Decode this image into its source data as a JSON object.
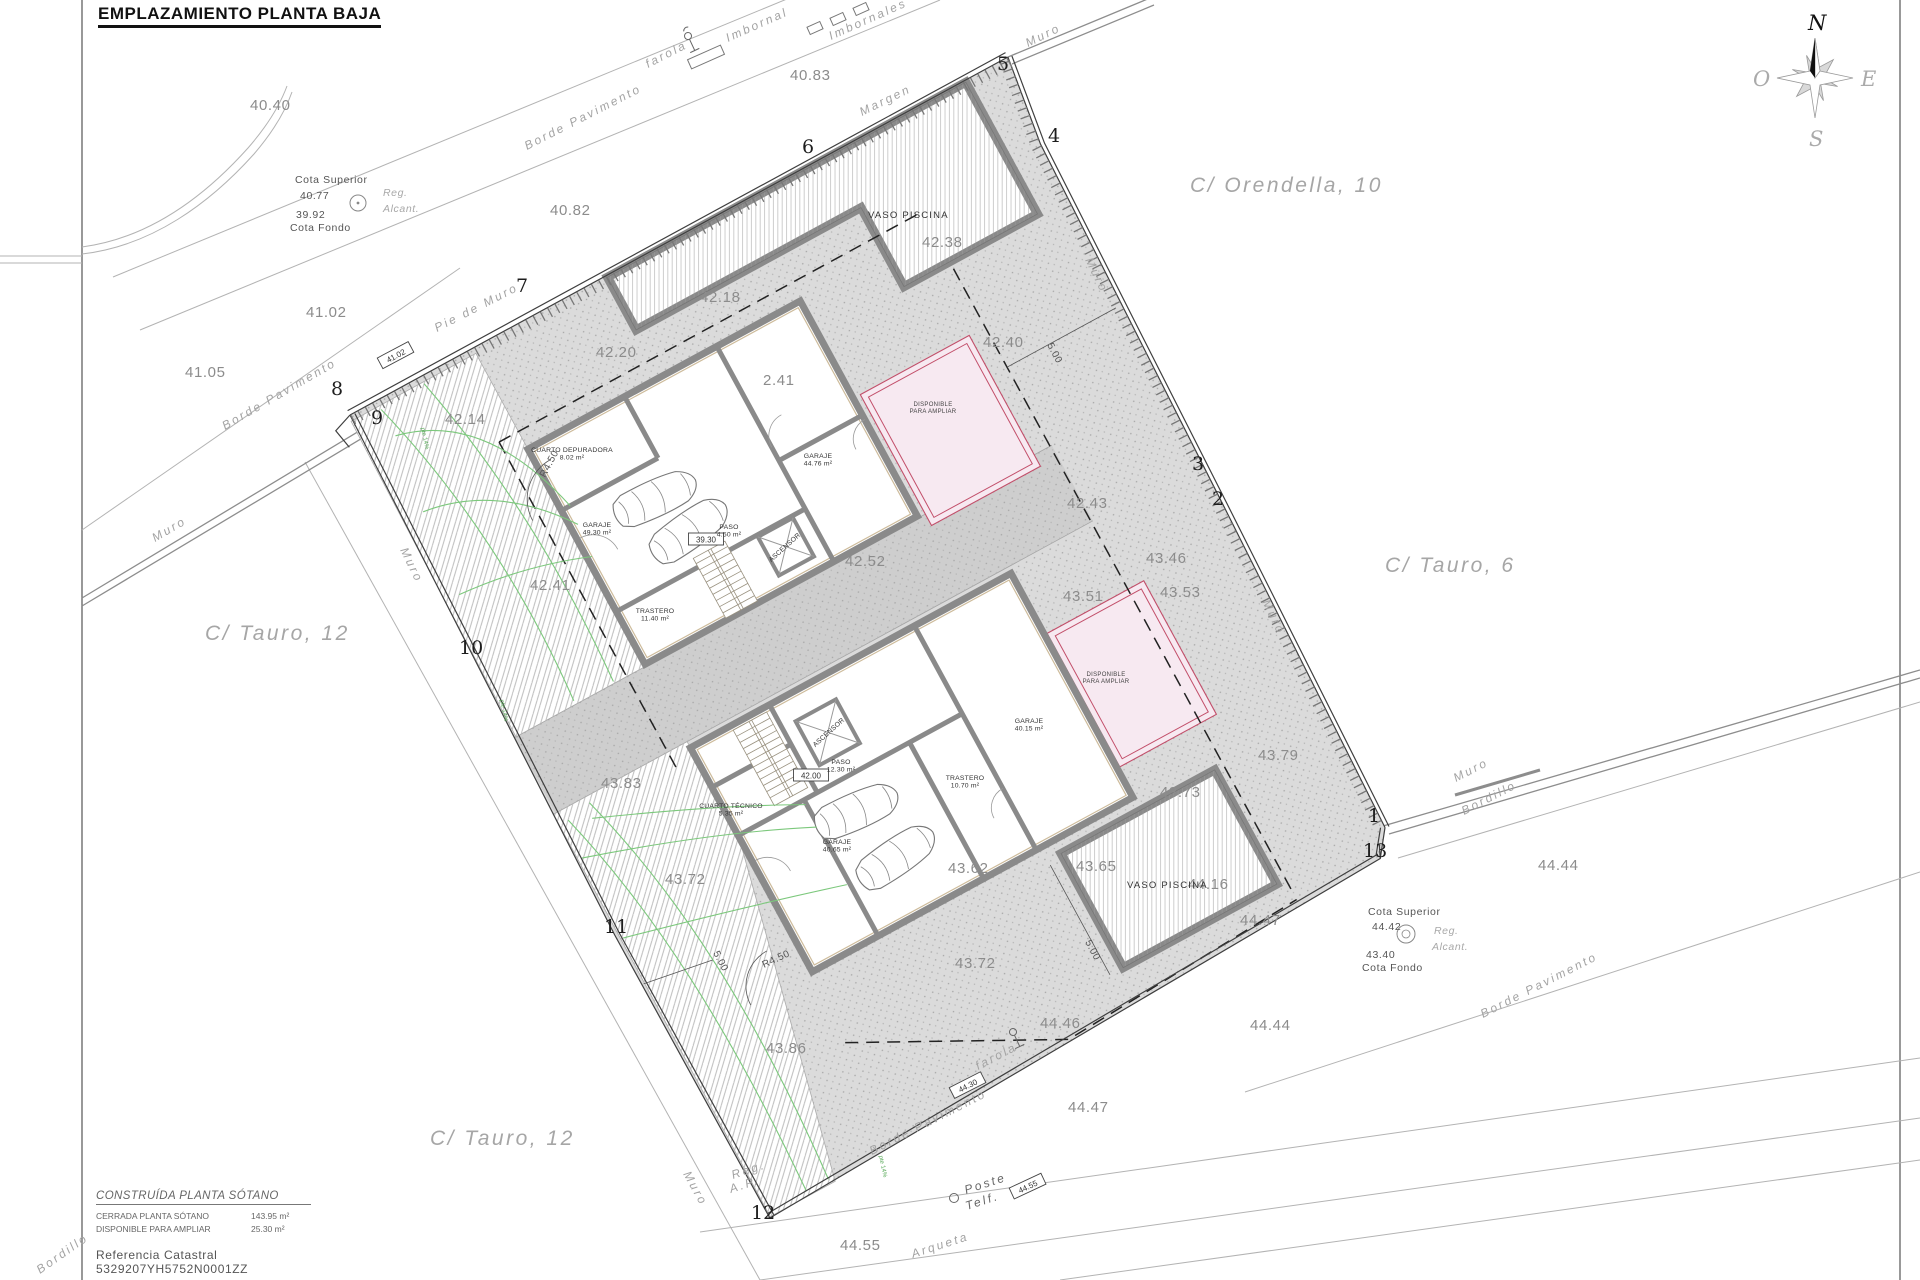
{
  "title": "EMPLAZAMIENTO PLANTA BAJA",
  "compass": {
    "n": "N",
    "s": "S",
    "e": "E",
    "w": "O"
  },
  "legend": {
    "title": "CONSTRUÍDA PLANTA SÓTANO",
    "rows": [
      {
        "label": "CERRADA PLANTA SÓTANO",
        "value": "143.95 m²"
      },
      {
        "label": "DISPONIBLE PARA AMPLIAR",
        "value": "25.30 m²"
      }
    ],
    "ref": "Referencia  Catastral  5329207YH5752N0001ZZ"
  },
  "cota1": {
    "l1": "Cota  Superior",
    "v1": "40.77",
    "reg": "Reg.",
    "alc": "Alcant.",
    "v2": "39.92",
    "l2": "Cota  Fondo"
  },
  "cota2": {
    "l1": "Cota  Superior",
    "v1": "44.42",
    "reg": "Reg.",
    "alc": "Alcant.",
    "v2": "43.40",
    "l2": "Cota  Fondo"
  },
  "streets": [
    {
      "t": "C/  Orendella,  10",
      "x": 1190,
      "y": 192
    },
    {
      "t": "C/  Tauro,  6",
      "x": 1385,
      "y": 572
    },
    {
      "t": "C/  Tauro,  12",
      "x": 205,
      "y": 640
    },
    {
      "t": "C/  Tauro,  12",
      "x": 430,
      "y": 1145
    }
  ],
  "elevations": [
    {
      "t": "40.40",
      "x": 250,
      "y": 110
    },
    {
      "t": "40.82",
      "x": 550,
      "y": 215
    },
    {
      "t": "40.83",
      "x": 790,
      "y": 80
    },
    {
      "t": "41.02",
      "x": 306,
      "y": 317
    },
    {
      "t": "41.05",
      "x": 185,
      "y": 377
    },
    {
      "t": "42.14",
      "x": 445,
      "y": 424
    },
    {
      "t": "42.18",
      "x": 700,
      "y": 302
    },
    {
      "t": "42.20",
      "x": 596,
      "y": 357
    },
    {
      "t": "42.38",
      "x": 922,
      "y": 247
    },
    {
      "t": "42.40",
      "x": 983,
      "y": 347
    },
    {
      "t": "2.41",
      "x": 763,
      "y": 385
    },
    {
      "t": "42.41",
      "x": 530,
      "y": 590
    },
    {
      "t": "42.43",
      "x": 1067,
      "y": 508
    },
    {
      "t": "42.52",
      "x": 845,
      "y": 566
    },
    {
      "t": "43.46",
      "x": 1146,
      "y": 563
    },
    {
      "t": "43.51",
      "x": 1063,
      "y": 601
    },
    {
      "t": "43.53",
      "x": 1160,
      "y": 597
    },
    {
      "t": "43.62",
      "x": 948,
      "y": 873
    },
    {
      "t": "43.65",
      "x": 1076,
      "y": 871
    },
    {
      "t": "43.72",
      "x": 665,
      "y": 884
    },
    {
      "t": "43.72",
      "x": 955,
      "y": 968
    },
    {
      "t": "43.73",
      "x": 1160,
      "y": 797
    },
    {
      "t": "43.79",
      "x": 1258,
      "y": 760
    },
    {
      "t": "43.83",
      "x": 601,
      "y": 788
    },
    {
      "t": "43.86",
      "x": 766,
      "y": 1053
    },
    {
      "t": "44.16",
      "x": 1188,
      "y": 889
    },
    {
      "t": "44.44",
      "x": 1538,
      "y": 870
    },
    {
      "t": "44.44",
      "x": 1250,
      "y": 1030
    },
    {
      "t": "44.46",
      "x": 1040,
      "y": 1028
    },
    {
      "t": "44.47",
      "x": 1240,
      "y": 925
    },
    {
      "t": "44.47",
      "x": 1068,
      "y": 1112
    },
    {
      "t": "44.55",
      "x": 840,
      "y": 1250
    }
  ],
  "vertices": [
    {
      "t": "1",
      "x": 1368,
      "y": 822
    },
    {
      "t": "2",
      "x": 1212,
      "y": 505
    },
    {
      "t": "3",
      "x": 1192,
      "y": 470
    },
    {
      "t": "4",
      "x": 1048,
      "y": 142
    },
    {
      "t": "5",
      "x": 997,
      "y": 70
    },
    {
      "t": "6",
      "x": 802,
      "y": 153
    },
    {
      "t": "7",
      "x": 516,
      "y": 292
    },
    {
      "t": "8",
      "x": 331,
      "y": 395
    },
    {
      "t": "9",
      "x": 371,
      "y": 424
    },
    {
      "t": "10",
      "x": 459,
      "y": 654
    },
    {
      "t": "11",
      "x": 604,
      "y": 933
    },
    {
      "t": "12",
      "x": 751,
      "y": 1219
    },
    {
      "t": "13",
      "x": 1363,
      "y": 857
    }
  ],
  "slanted": [
    {
      "t": "Borde  Pavimento",
      "x": 527,
      "y": 150,
      "r": -27
    },
    {
      "t": "Borde  Pavimento",
      "x": 225,
      "y": 430,
      "r": -30
    },
    {
      "t": "Borde  Pavimento",
      "x": 872,
      "y": 1155,
      "r": -27
    },
    {
      "t": "Borde  Pavimento",
      "x": 1483,
      "y": 1018,
      "r": -27
    },
    {
      "t": "Bordillo",
      "x": 1464,
      "y": 815,
      "r": -27
    },
    {
      "t": "Bordillo",
      "x": 40,
      "y": 1274,
      "r": -35
    },
    {
      "t": "Margen",
      "x": 862,
      "y": 116,
      "r": -26,
      "ls": 7
    },
    {
      "t": "Pie  de  Muro",
      "x": 437,
      "y": 332,
      "r": -27,
      "ls": 5
    },
    {
      "t": "Muro",
      "x": 1028,
      "y": 47,
      "r": -26,
      "ls": 5
    },
    {
      "t": "Muro",
      "x": 1085,
      "y": 260,
      "r": 64,
      "ls": 5
    },
    {
      "t": "Muro",
      "x": 1262,
      "y": 602,
      "r": 64,
      "ls": 5
    },
    {
      "t": "Muro",
      "x": 155,
      "y": 542,
      "r": -30,
      "ls": 7
    },
    {
      "t": "Muro",
      "x": 400,
      "y": 550,
      "r": 64,
      "ls": 5
    },
    {
      "t": "Muro",
      "x": 683,
      "y": 1174,
      "r": 61,
      "ls": 5
    },
    {
      "t": "Muro",
      "x": 1456,
      "y": 782,
      "r": -27,
      "ls": 5
    },
    {
      "t": "farola",
      "x": 648,
      "y": 68,
      "r": -27
    },
    {
      "t": "farola",
      "x": 978,
      "y": 1070,
      "r": -27
    },
    {
      "t": "Imbornal",
      "x": 728,
      "y": 42,
      "r": -24
    },
    {
      "t": "Imbornales",
      "x": 831,
      "y": 40,
      "r": -24
    },
    {
      "t": "Arqueta",
      "x": 913,
      "y": 1258,
      "r": -18
    },
    {
      "t": "Poste",
      "x": 966,
      "y": 1194,
      "r": -18,
      "cls": "dark"
    },
    {
      "t": "Telf.",
      "x": 967,
      "y": 1210,
      "r": -18,
      "cls": "dark"
    },
    {
      "t": "Reg.",
      "x": 733,
      "y": 1179,
      "r": -18
    },
    {
      "t": "A.P.",
      "x": 731,
      "y": 1193,
      "r": -18
    }
  ],
  "boxed": [
    {
      "t": "41.02",
      "x": 396,
      "y": 356,
      "r": -28
    },
    {
      "t": "39.30",
      "x": 706,
      "y": 540,
      "r": 0
    },
    {
      "t": "42.00",
      "x": 811,
      "y": 776,
      "r": 0
    },
    {
      "t": "44.30",
      "x": 968,
      "y": 1086,
      "r": -27
    },
    {
      "t": "44.55",
      "x": 1028,
      "y": 1187,
      "r": -25
    }
  ],
  "dims": [
    {
      "t": "5.00",
      "x": 1047,
      "y": 345,
      "r": 62
    },
    {
      "t": "5.00",
      "x": 1085,
      "y": 942,
      "r": 62
    },
    {
      "t": "5.00",
      "x": 713,
      "y": 953,
      "r": 62
    },
    {
      "t": "R4.50",
      "x": 545,
      "y": 478,
      "r": -62
    },
    {
      "t": "R4.50",
      "x": 764,
      "y": 968,
      "r": -25
    }
  ],
  "greens": [
    {
      "t": "pte 14%",
      "x": 421,
      "y": 428,
      "r": 78
    },
    {
      "t": "pte 14%",
      "x": 500,
      "y": 700,
      "r": 78
    },
    {
      "t": "pte 14%",
      "x": 879,
      "y": 1156,
      "r": 78
    }
  ],
  "rooms": [
    {
      "n": "CUARTO DEPURADORA",
      "a": "8.02 m²",
      "x": 572,
      "y": 452
    },
    {
      "n": "GARAJE",
      "a": "49.30 m²",
      "x": 597,
      "y": 527
    },
    {
      "n": "GARAJE",
      "a": "44.76 m²",
      "x": 818,
      "y": 458
    },
    {
      "n": "PASO",
      "a": "4.50 m²",
      "x": 729,
      "y": 529
    },
    {
      "n": "TRASTERO",
      "a": "11.40 m²",
      "x": 655,
      "y": 613
    },
    {
      "n": "ASCENSOR",
      "a": "",
      "x": 786,
      "y": 549,
      "r": -42
    },
    {
      "n": "PASO",
      "a": "12.30 m²",
      "x": 841,
      "y": 764
    },
    {
      "n": "CUARTO TÉCNICO",
      "a": "5.35 m²",
      "x": 731,
      "y": 808
    },
    {
      "n": "TRASTERO",
      "a": "10.70 m²",
      "x": 965,
      "y": 780
    },
    {
      "n": "GARAJE",
      "a": "40.65 m²",
      "x": 837,
      "y": 844
    },
    {
      "n": "GARAJE",
      "a": "40.15 m²",
      "x": 1029,
      "y": 723
    },
    {
      "n": "ASCENSOR",
      "a": "",
      "x": 830,
      "y": 734,
      "r": -42
    }
  ],
  "pools": [
    {
      "t": "VASO PISCINA",
      "x": 868,
      "y": 218
    },
    {
      "t": "VASO PISCINA",
      "x": 1127,
      "y": 888
    }
  ],
  "pink": {
    "l1": "DISPONIBLE",
    "l2": "PARA AMPLIAR",
    "positions": [
      {
        "x": 933,
        "y": 406
      },
      {
        "x": 1106,
        "y": 676
      }
    ]
  },
  "colors": {
    "pink": "#f7e9f1",
    "pink_border": "#c24f6a",
    "wall": "#8a8a8a",
    "green": "#7cc87c",
    "ground": "#dbdbdb"
  }
}
